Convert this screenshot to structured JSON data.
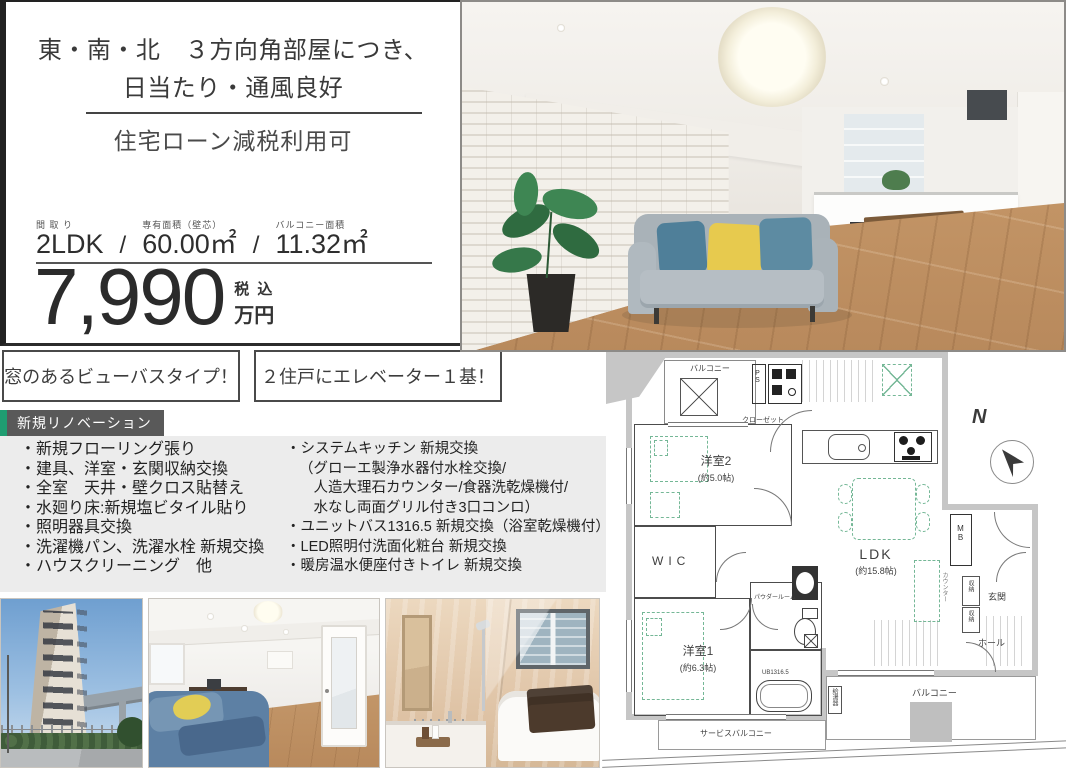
{
  "info": {
    "headline_line1": "東・南・北　３方向角部屋につき、",
    "headline_line2": "日当たり・通風良好",
    "subheadline": "住宅ローン減税利用可",
    "specs": {
      "madori_label": "間 取 り",
      "madori_value": "2LDK",
      "area_label": "専有面積（壁芯）",
      "area_value": "60.00㎡",
      "balcony_label": "バルコニー面積",
      "balcony_value": "11.32㎡",
      "separator": "/"
    },
    "price": {
      "amount": "7,990",
      "tax_note": "税 込",
      "unit": "万円"
    }
  },
  "badges": {
    "badge1": "窓のあるビューバスタイプ！",
    "badge2": "２住戸にエレベーター１基！"
  },
  "renovation": {
    "tag": "新規リノベーション",
    "left_items": [
      "・新規フローリング張り",
      "・建具、洋室・玄関収納交換",
      "・全室　天井・壁クロス貼替え",
      "・水廻り床:新規塩ビタイル貼り",
      "・照明器具交換",
      "・洗濯機パン、洗濯水栓 新規交換",
      "・ハウスクリーニング　他"
    ],
    "right_items": [
      "・システムキッチン 新規交換",
      "（グローエ製浄水器付水栓交換/",
      "　人造大理石カウンター/食器洗乾燥機付/",
      "　水なし両面グリル付き3口コンロ）",
      "・ユニットバス1316.5 新規交換（浴室乾燥機付）",
      "・LED照明付洗面化粧台 新規交換",
      "・暖房温水便座付きトイレ 新規交換"
    ]
  },
  "floorplan": {
    "balcony_top": "バルコニー",
    "ps": "PS",
    "closet": "クローゼット",
    "room2_name": "洋室2",
    "room2_size": "(約5.0帖)",
    "wic": "WIC",
    "ldk_name": "LDK",
    "ldk_size": "(約15.8帖)",
    "room1_name": "洋室1",
    "room1_size": "(約6.3帖)",
    "ub": "UB1316.5",
    "powder_room": "パウダールーム",
    "mb": "MB",
    "counter": "カウンター",
    "storage1": "収納",
    "storage2": "収納",
    "genkan": "玄関",
    "hall": "ホール",
    "water_heater": "給湯器",
    "balcony_bottom": "バルコニー",
    "service_balcony": "サービスバルコニー",
    "compass": "N"
  },
  "colors": {
    "accent_green": "#1f9d71",
    "tag_gray": "#595959",
    "list_bg": "#ececec",
    "plan_wall_gray": "#c6c6c6",
    "plan_furniture_green": "#74b796"
  }
}
